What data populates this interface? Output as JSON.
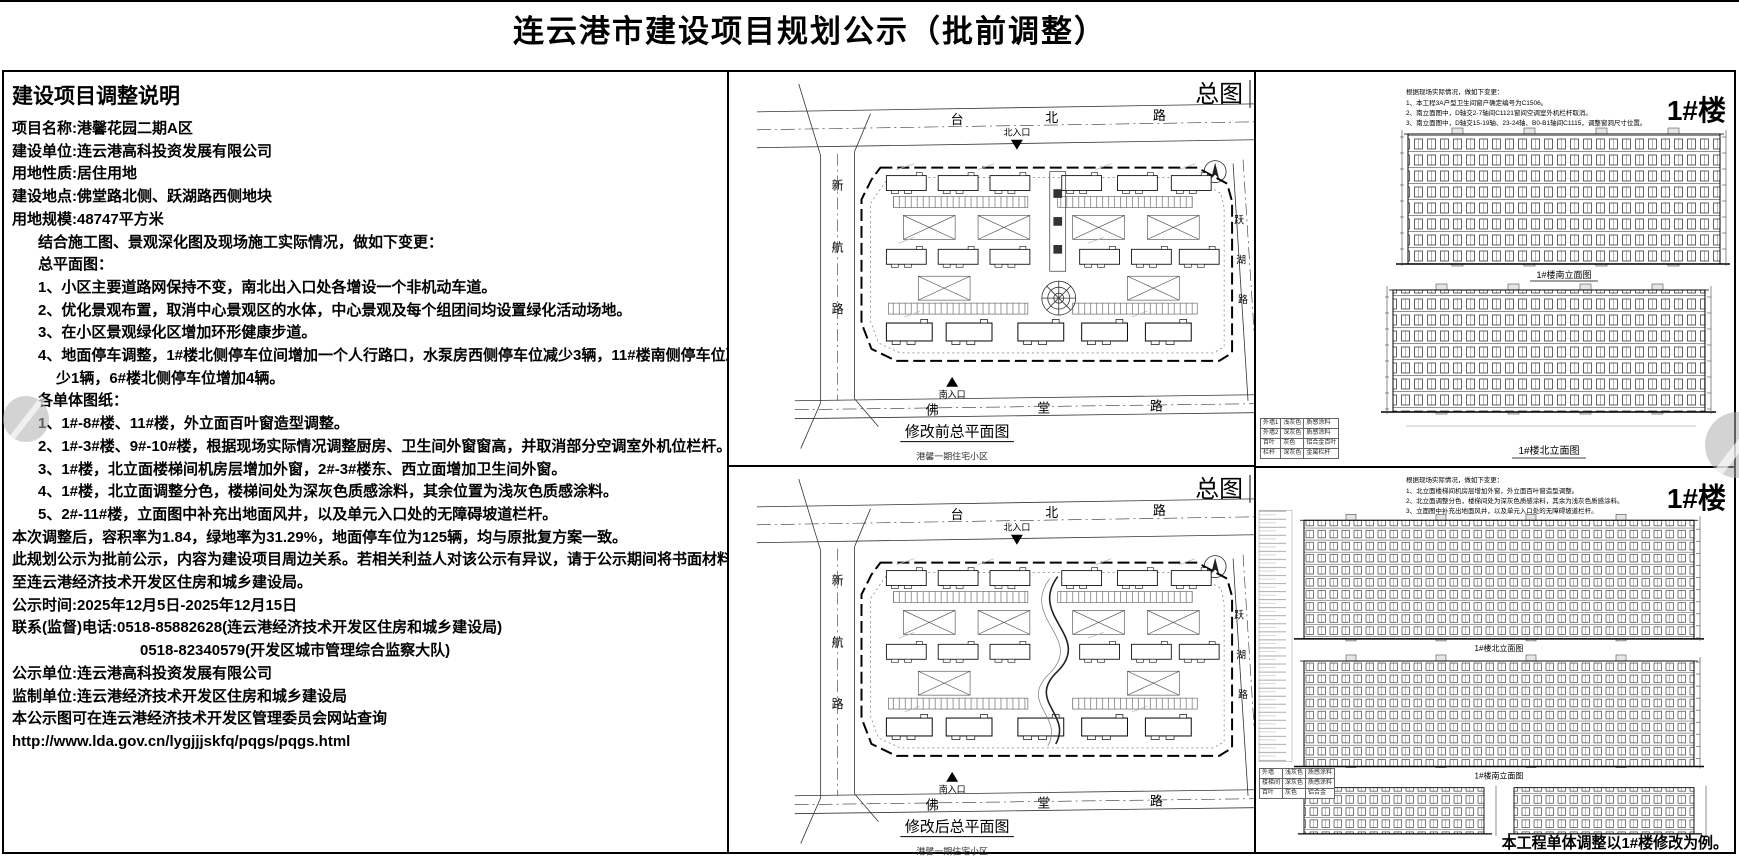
{
  "title": "连云港市建设项目规划公示（批前调整）",
  "left_panel": {
    "heading": "建设项目调整说明",
    "lines": [
      "项目名称:港馨花园二期A区",
      "建设单位:连云港高科投资发展有限公司",
      "用地性质:居住用地",
      "建设地点:佛堂路北侧、跃湖路西侧地块",
      "用地规模:48747平方米",
      "结合施工图、景观深化图及现场施工实际情况，做如下变更：",
      "总平面图：",
      "1、小区主要道路网保持不变，南北出入口处各增设一个非机动车道。",
      "2、优化景观布置，取消中心景观区的水体，中心景观及每个组团间均设置绿化活动场地。",
      "3、在小区景观绿化区增加环形健康步道。",
      "4、地面停车调整，1#楼北侧停车位间增加一个人行路口，水泵房西侧停车位减少3辆，11#楼南侧停车位减",
      "少1辆，6#楼北侧停车位增加4辆。",
      "各单体图纸：",
      "1、1#-8#楼、11#楼，外立面百叶窗造型调整。",
      "2、1#-3#楼、9#-10#楼，根据现场实际情况调整厨房、卫生间外窗窗高，并取消部分空调室外机位栏杆。",
      "3、1#楼，北立面楼梯间机房层增加外窗，2#-3#楼东、西立面增加卫生间外窗。",
      "4、1#楼，北立面调整分色，楼梯间处为深灰色质感涂料，其余位置为浅灰色质感涂料。",
      "5、2#-11#楼，立面图中补充出地面风井，以及单元入口处的无障碍坡道栏杆。",
      "本次调整后，容积率为1.84，绿地率为31.29%，地面停车位为125辆，均与原批复方案一致。",
      "此规划公示为批前公示，内容为建设项目周边关系。若相关利益人对该公示有异议，请于公示期间将书面材料送交",
      "至连云港经济技术开发区住房和城乡建设局。",
      "公示时间:2025年12月5日-2025年12月15日",
      "联系(监督)电话:0518-85882628(连云港经济技术开发区住房和城乡建设局)",
      "0518-82340579(开发区城市管理综合监察大队)",
      "公示单位:连云港高科投资发展有限公司",
      "监制单位:连云港经济技术开发区住房和城乡建设局",
      "本公示图可在连云港经济技术开发区管理委员会网站查询",
      "http://www.lda.gov.cn/lygjjjskfq/pqgs/pqgs.html"
    ]
  },
  "site_plan_top": {
    "corner_label": "总图",
    "road_north": [
      "台",
      "北",
      "路"
    ],
    "road_south": [
      "佛",
      "堂",
      "路"
    ],
    "road_west": [
      "新",
      "航",
      "路"
    ],
    "road_east": [
      "跃",
      "湖",
      "路"
    ],
    "entrance_north": "北入口",
    "entrance_south": "南入口",
    "caption": "修改前总平面图",
    "subcaption": "港馨一期住宅小区"
  },
  "site_plan_bottom": {
    "corner_label": "总图",
    "road_north": [
      "台",
      "北",
      "路"
    ],
    "road_south": [
      "佛",
      "堂",
      "路"
    ],
    "road_west": [
      "新",
      "航",
      "路"
    ],
    "road_east": [
      "跃",
      "湖",
      "路"
    ],
    "entrance_north": "北入口",
    "entrance_south": "南入口",
    "caption": "修改后总平面图",
    "subcaption": "港馨一期住宅小区"
  },
  "elevation_top": {
    "building_label": "1#楼",
    "notes": [
      "根据现场实际情况，做如下变更：",
      "1、本工程3A户型卫生间窗户确定编号为C1506。",
      "2、南立面图中，D轴交2-7轴间C1121窗间空调室外机栏杆取消。",
      "3、南立面图中，D轴交15-19轴、23-24轴、B0-B1轴间C1115，调整窗洞尺寸位置。"
    ],
    "captions": [
      "1#楼南立面图",
      "1#楼北立面图"
    ],
    "materials_table": [
      [
        "外墙1",
        "浅灰色",
        "质感涂料"
      ],
      [
        "外墙2",
        "深灰色",
        "质感涂料"
      ],
      [
        "百叶",
        "灰色",
        "铝合金百叶"
      ],
      [
        "栏杆",
        "深灰色",
        "金属栏杆"
      ]
    ]
  },
  "elevation_bottom": {
    "building_label": "1#楼",
    "notes": [
      "根据现场实际情况，做如下变更：",
      "1、北立面楼梯间机房层增加外窗，外立面百叶窗造型调整。",
      "2、北立面调整分色，楼梯间处为深灰色质感涂料，其余为浅灰色质感涂料。",
      "3、立面图中补充出地面风井，以及单元入口处的无障碍坡道栏杆。"
    ],
    "captions": [
      "1#楼北立面图",
      "1#楼南立面图"
    ],
    "materials_table": [
      [
        "外墙",
        "浅灰色",
        "质感涂料"
      ],
      [
        "楼梯间",
        "深灰色",
        "质感涂料"
      ],
      [
        "百叶",
        "灰色",
        "铝合金"
      ]
    ],
    "footnote": "本工程单体调整以1#楼修改为例。"
  }
}
